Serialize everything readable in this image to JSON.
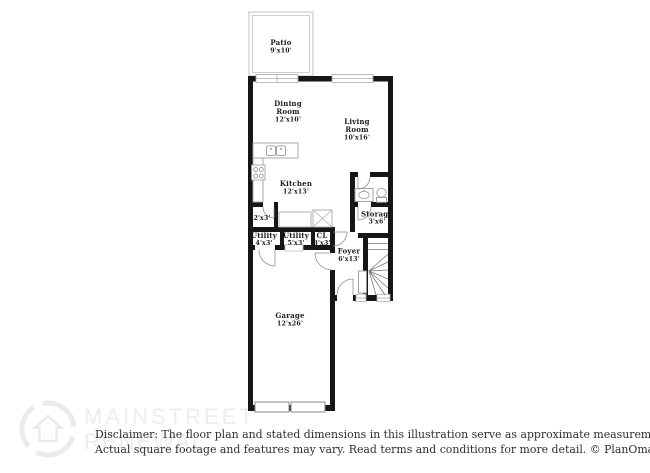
{
  "image": {
    "width": 650,
    "height": 473,
    "background": "#ffffff"
  },
  "floorplan": {
    "wall_color": "#161616",
    "fixture_line_color": "#999999",
    "label_color": "#1c1c1c",
    "rooms": [
      {
        "id": "patio",
        "name": "Patio",
        "dims": "9'x10'"
      },
      {
        "id": "dining-room",
        "name": "Dining",
        "name2": "Room",
        "dims": "12'x10'"
      },
      {
        "id": "living-room",
        "name": "Living",
        "name2": "Room",
        "dims": "10'x16'"
      },
      {
        "id": "kitchen",
        "name": "Kitchen",
        "dims": "12'x13'"
      },
      {
        "id": "closet-2x3",
        "dims": "2'x3'"
      },
      {
        "id": "utility-a",
        "name": "Utility",
        "dims": "4'x3'"
      },
      {
        "id": "utility-b",
        "name": "Utility",
        "dims": "5'x3'"
      },
      {
        "id": "closet-cl",
        "name": "CL",
        "dims": "3'x3'"
      },
      {
        "id": "storage",
        "name": "Storage",
        "dims": "3'x6'"
      },
      {
        "id": "foyer",
        "name": "Foyer",
        "dims": "6'x13'"
      },
      {
        "id": "garage",
        "name": "Garage",
        "dims": "12'x26'"
      }
    ],
    "fixtures": [
      "kitchen-double-sink",
      "stove-cooktop",
      "bathroom-vanity-sink",
      "toilet",
      "staircase",
      "closet-shelves-x",
      "washer-dryer-space",
      "garage-door-panels",
      "entry-door",
      "patio-sliding-door",
      "windows",
      "door-swing-arcs"
    ]
  },
  "watermark": {
    "logo": "mainstreet-renewal-logo",
    "line1": "MAINSTREET",
    "line2": "RENEWAL",
    "color": "#ededed"
  },
  "disclaimer": {
    "line1": "Disclaimer: The floor plan and stated dimensions in this illustration serve as approximate measurements.",
    "line2": "Actual square footage and features may vary. Read terms and conditions for more detail. © PlanOmatic",
    "color": "#2e2e2e"
  }
}
